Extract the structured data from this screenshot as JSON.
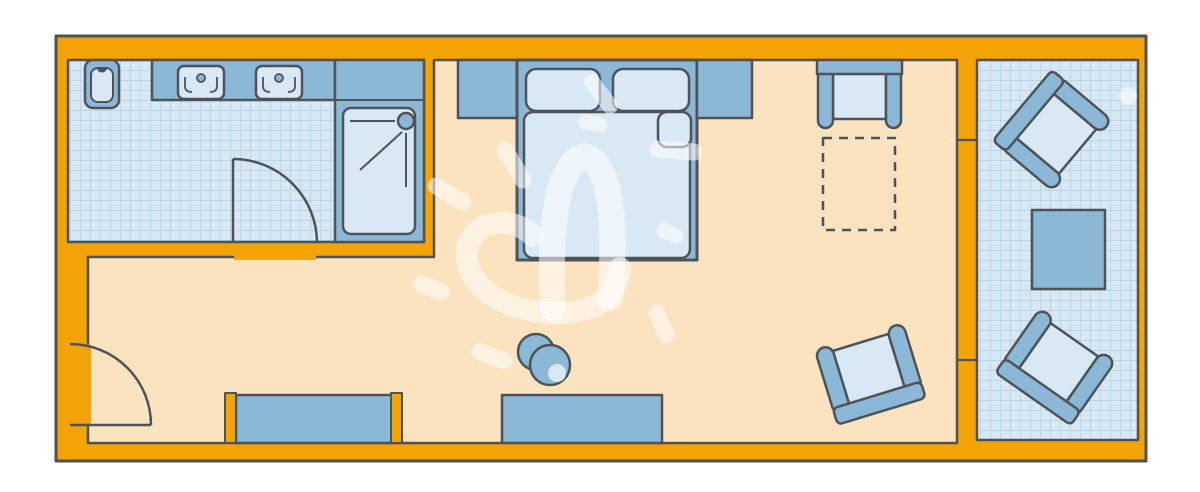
{
  "meta": {
    "title": "Hotel room floor plan",
    "diagram_type": "floor-plan",
    "visible_text": "none"
  },
  "palette": {
    "wall_orange": "#F4A306",
    "outline_dark": "#4E5358",
    "floor_peach": "#FBE3BF",
    "tile_light": "#D7E8F4",
    "tile_grid": "#AFD0E4",
    "furniture_blue": "#8CB8D7",
    "furniture_light": "#D8E9F5",
    "watermark_white": "rgba(255,255,255,0.55)",
    "background_white": "#FFFFFF"
  },
  "rooms": [
    {
      "id": "bathroom",
      "position": "top-left",
      "floor_finish": "blue-tile-grid",
      "fixtures": [
        "toilet",
        "vanity-counter",
        "sink",
        "sink",
        "shower-enclosure",
        "shower-tray",
        "swing-door"
      ]
    },
    {
      "id": "bedroom",
      "position": "center",
      "floor_finish": "plain-peach",
      "fixtures": [
        "nightstand-left",
        "double-bed",
        "pillow",
        "pillow",
        "mattress",
        "folded-sheet-corner",
        "nightstand-right",
        "luggage-bench",
        "crib-space-dashed-outline",
        "wardrobe-niche",
        "desk",
        "round-stool",
        "armchair-rotated",
        "entrance-swing-door"
      ]
    },
    {
      "id": "balcony",
      "position": "right",
      "floor_finish": "blue-tile-grid",
      "fixtures": [
        "armchair-rotated",
        "side-table",
        "armchair-rotated",
        "window-wall-divisions"
      ]
    }
  ],
  "watermark": "white hand-drawn heart doodle with sun rays over bedroom floor"
}
